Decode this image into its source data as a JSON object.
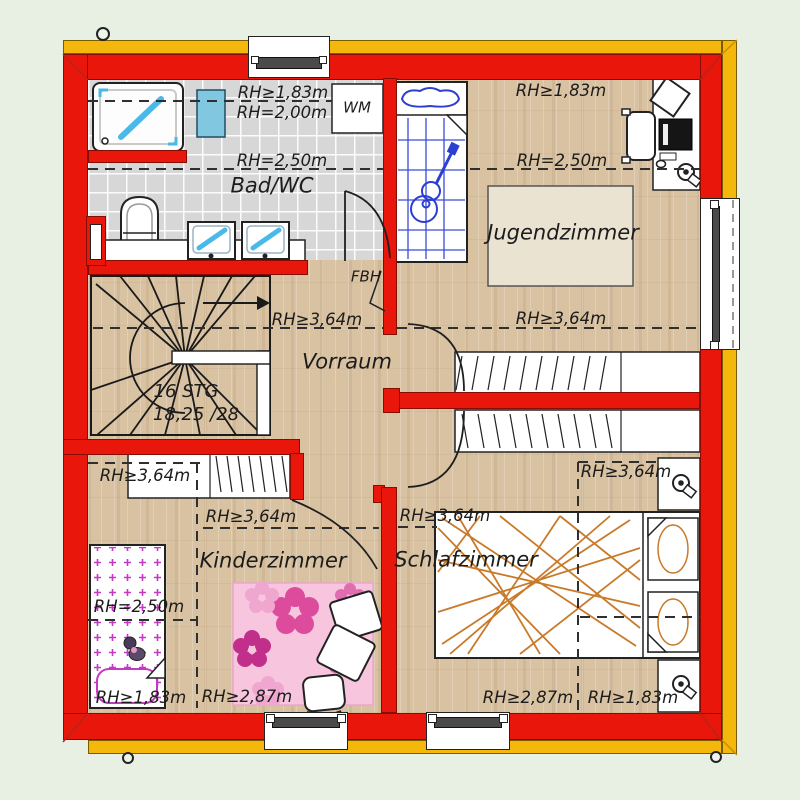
{
  "rooms": {
    "bad_wc": {
      "name": "Bad/WC",
      "rh_183": "RH≥1,83m",
      "rh_200": "RH=2,00m",
      "rh_250": "RH=2,50m"
    },
    "jugendzimmer": {
      "name": "Jugendzimmer",
      "rh_183": "RH≥1,83m",
      "rh_250": "RH=2,50m",
      "rh_364": "RH≥3,64m"
    },
    "vorraum": {
      "name": "Vorraum",
      "rh_364": "RH≥3,64m"
    },
    "kinderzimmer": {
      "name": "Kinderzimmer",
      "rh_364_a": "RH≥3,64m",
      "rh_364_b": "RH≥3,64m",
      "rh_250": "RH=2,50m",
      "rh_287": "RH≥2,87m",
      "rh_183": "RH≥1,83m"
    },
    "schlafzimmer": {
      "name": "Schlafzimmer",
      "rh_364_a": "RH≥3,64m",
      "rh_364_b": "RH≥3,64m",
      "rh_287": "RH≥2,87m",
      "rh_183": "RH≥1,83m"
    }
  },
  "stairs": {
    "steps": "16 STG",
    "rise_run": "18,25 /28"
  },
  "appliances": {
    "washing_machine": "WM",
    "floor_heating": "FBH"
  },
  "colors": {
    "exterior_wall": "#e9170b",
    "insulation": "#f4b70c",
    "bathroom_tile": "#d7d7d7",
    "wood_floor": "#d8c2a2",
    "background": "#e8f0e4",
    "sketch_blue": "#2d3fd0",
    "bed_orange": "#c97a28",
    "kids_pink": "#dd4b9d"
  }
}
